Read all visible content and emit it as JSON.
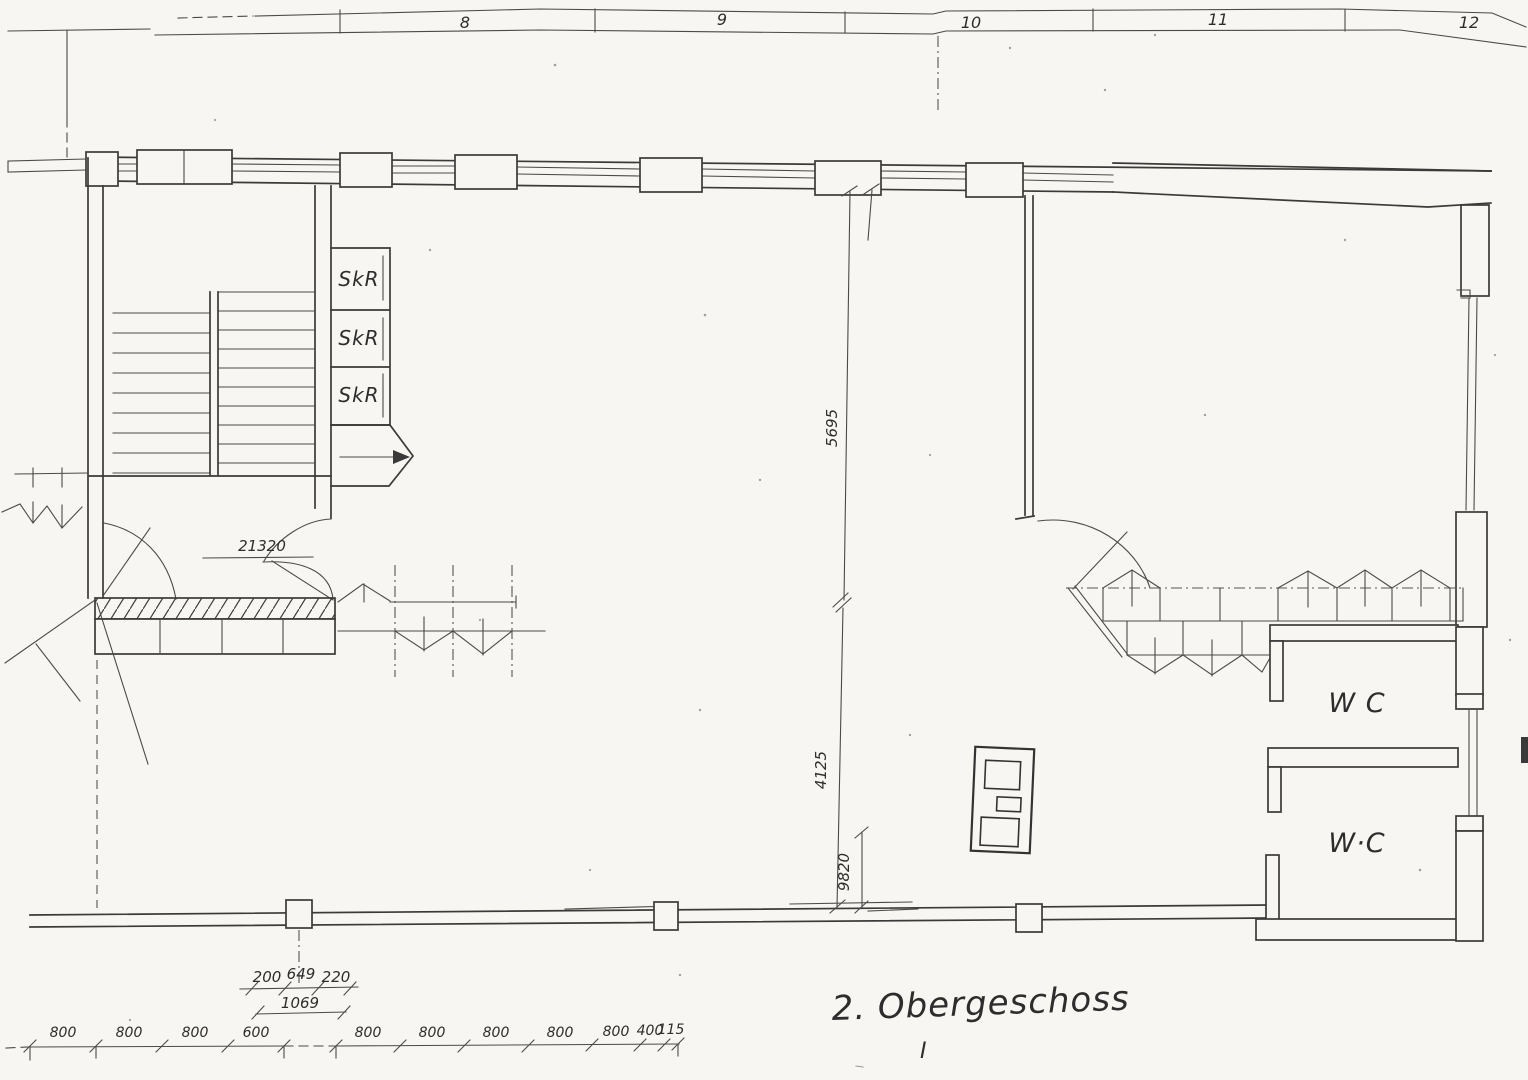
{
  "drawing": {
    "floor_title": "2. Obergeschoss",
    "floor_note": "I",
    "grid_labels": [
      "8",
      "9",
      "10",
      "11",
      "12"
    ],
    "rooms": {
      "skr_labels": [
        "SkR",
        "SkR",
        "SkR"
      ],
      "wc_labels": [
        "W C",
        "W·C"
      ]
    },
    "dims": {
      "corridor_width": "21320",
      "span_upper": "5695",
      "span_lower": "4125",
      "span_total": "9820",
      "col_left": "200",
      "col_mid": "649",
      "col_right": "220",
      "col_total": "1069",
      "chain": [
        "800",
        "800",
        "800",
        "600",
        "800",
        "800",
        "800",
        "800",
        "800",
        "400",
        "115"
      ]
    }
  }
}
